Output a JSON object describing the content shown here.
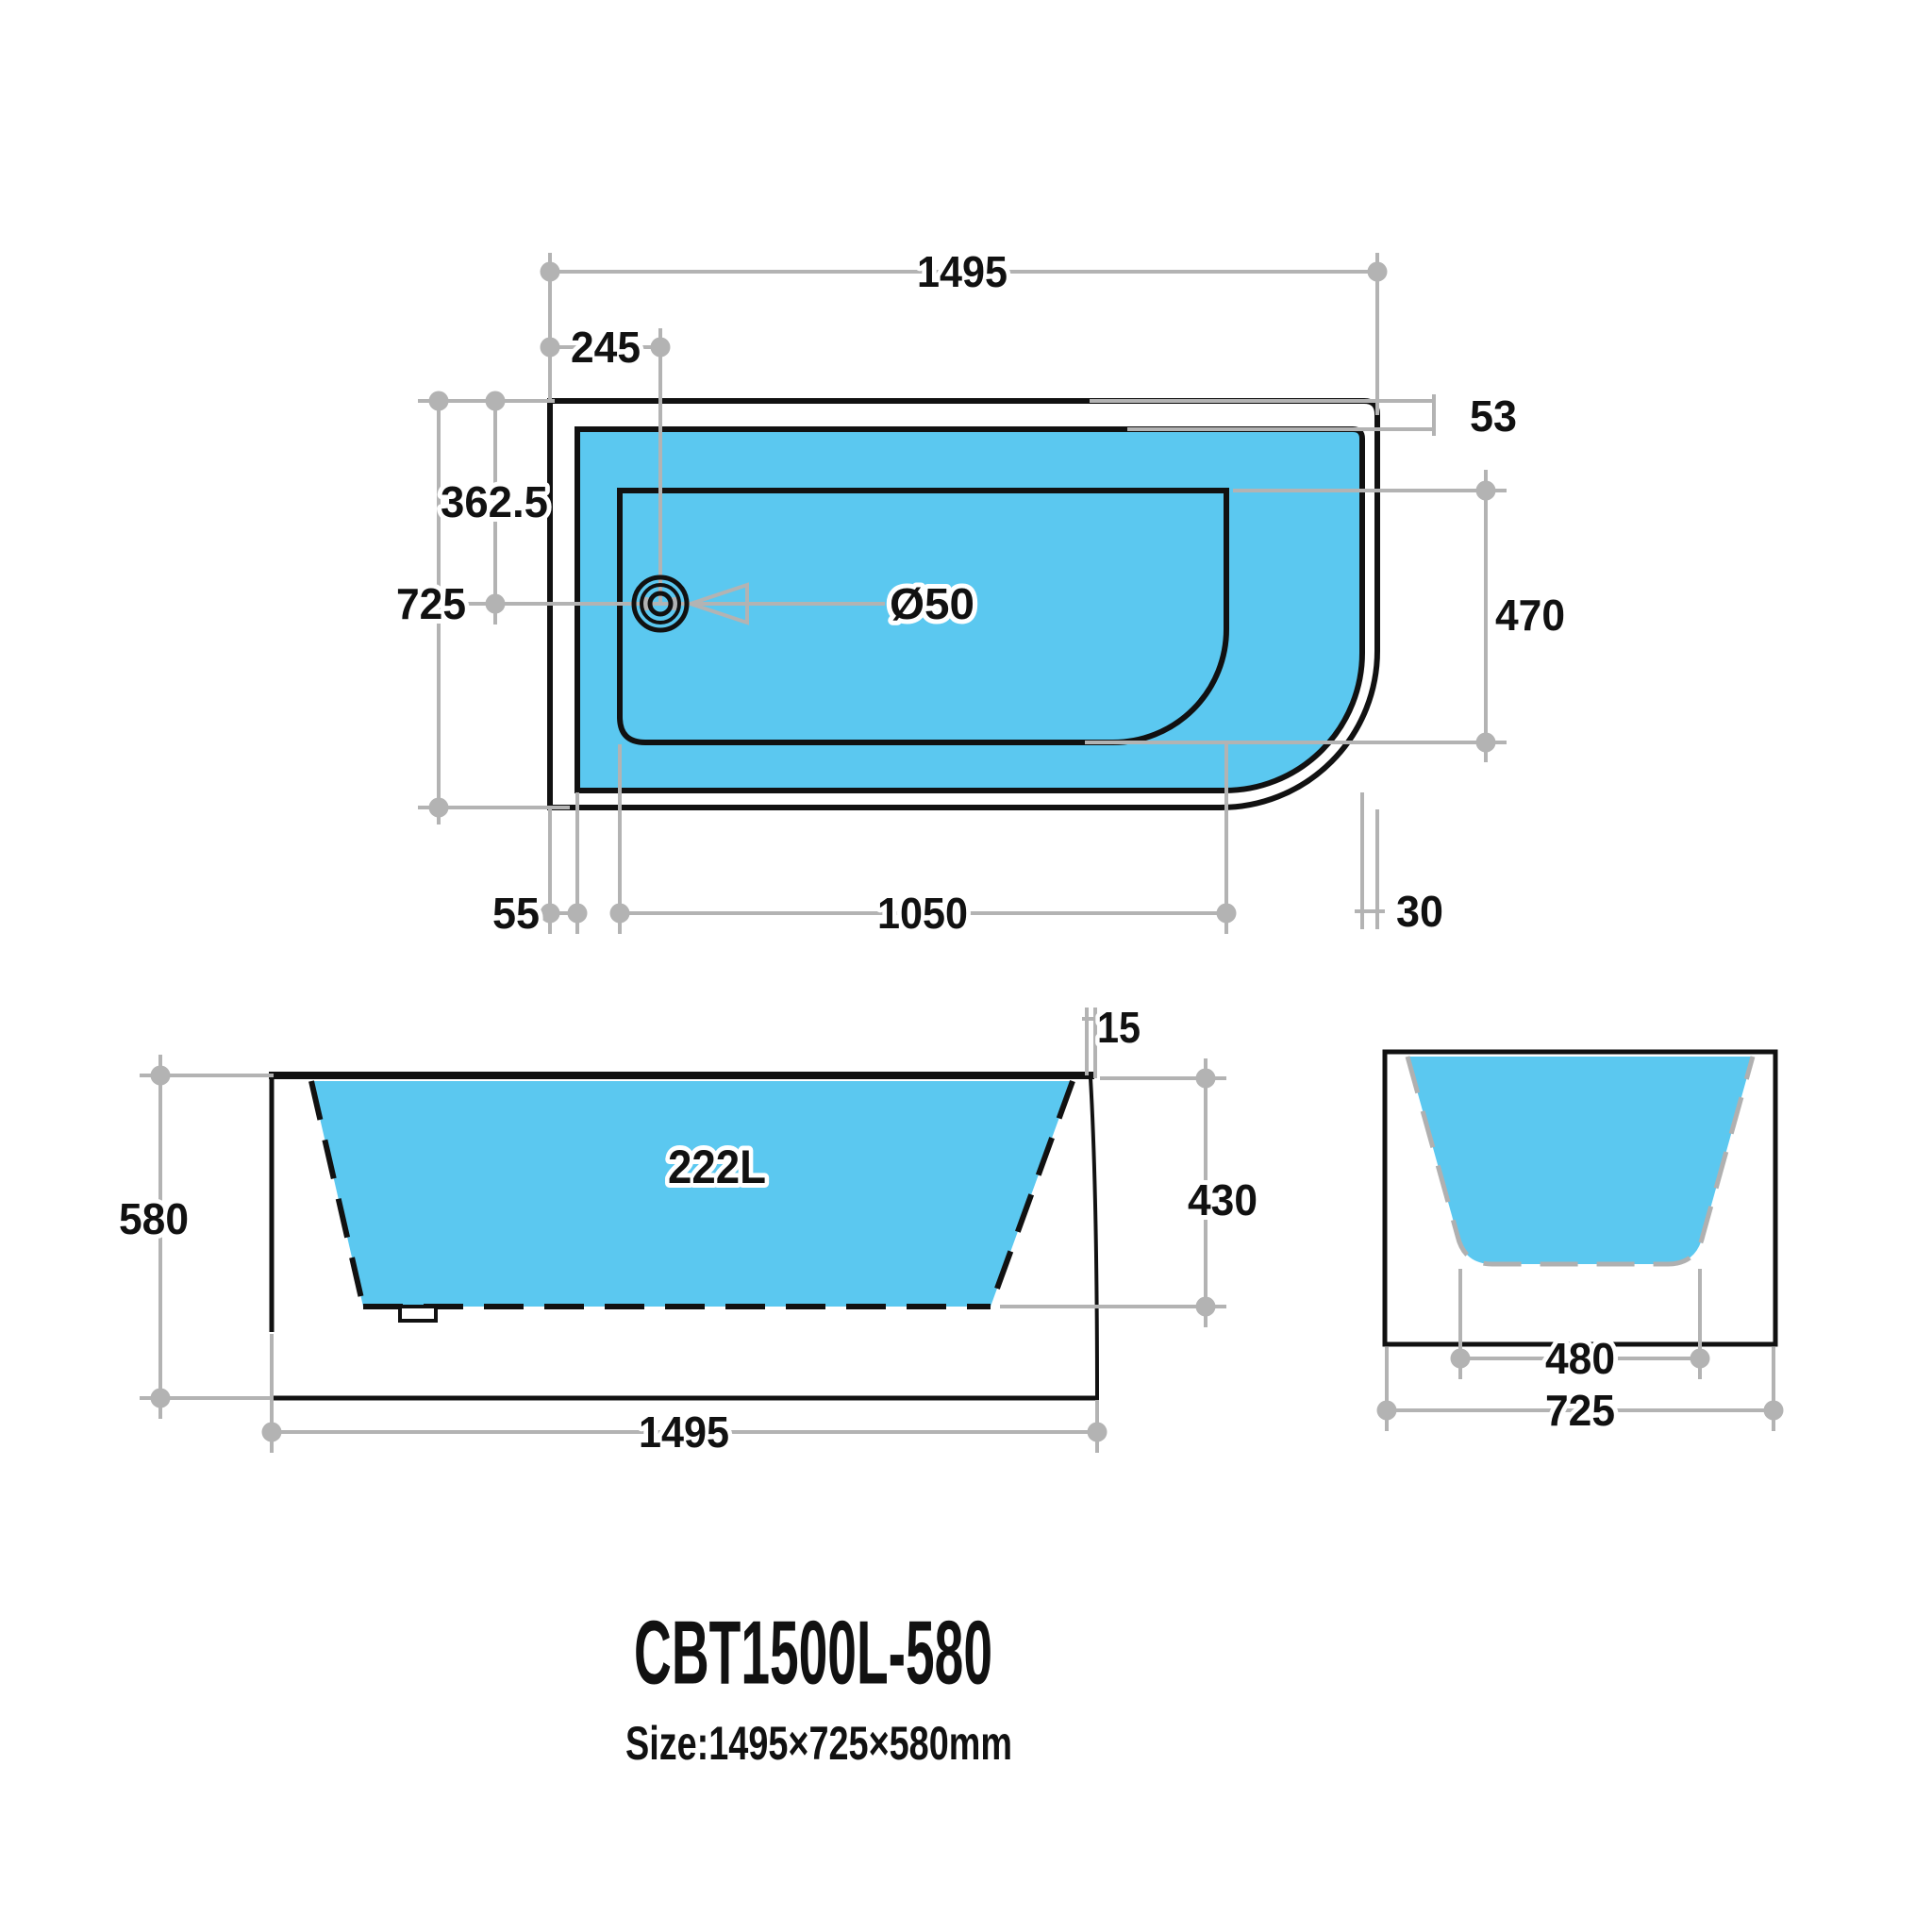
{
  "title": {
    "model": "CBT1500L-580",
    "size": "Size:1495×725×580mm"
  },
  "colors": {
    "tub_fill": "#5bc8f0",
    "dim_line": "#b3b3b3",
    "object_line": "#111111",
    "background": "#ffffff"
  },
  "top_view": {
    "dims": {
      "overall_length": "1495",
      "drain_offset": "245",
      "half_width": "362.5",
      "overall_width": "725",
      "back_rim_gap": "53",
      "inner_width": "470",
      "drain_diameter": "Ø50",
      "left_wall": "55",
      "inner_length": "1050",
      "right_wall": "30"
    }
  },
  "front_view": {
    "dims": {
      "overall_height": "580",
      "overall_length": "1495",
      "inner_depth": "430",
      "rim_thickness": "15"
    },
    "volume": "222L"
  },
  "end_view": {
    "dims": {
      "bottom_width": "480",
      "overall_width": "725"
    }
  }
}
